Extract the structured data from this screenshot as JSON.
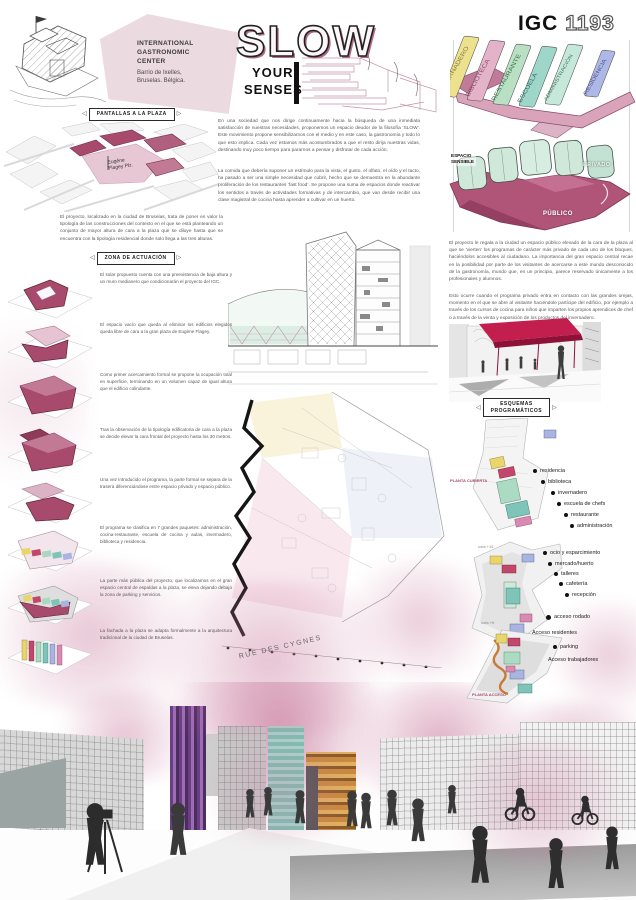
{
  "header": {
    "center_name_1": "INTERNATIONAL",
    "center_name_2": "GASTRONOMIC",
    "center_name_3": "CENTER",
    "center_loc_1": "Barrio de Ixelles,",
    "center_loc_2": "Bruselas. Bélgica.",
    "title_slow": "SLOW",
    "title_your": "YOUR",
    "title_senses": "SENSES",
    "code_prefix": "IGC",
    "code_number": "1193"
  },
  "left": {
    "tag_pantallas": "PANTALLAS A LA PLAZA",
    "map_label_1": "Eugène",
    "map_label_2": "Flagey Plz.",
    "intro": "El proyecto, localizado en la ciudad de Bruselas, trata de poner en valor la tipología de las construcciones del contexto en el que se está planteando un conjunto de mayor altura de cara a la plaza que se diluye hasta que se encuentra con la tipología residencial donde solo llega a las tres alturas.",
    "tag_zona": "ZONA DE ACTUACIÓN",
    "steps": [
      "El solar propuesto cuenta con una preexistencia de baja altura y un muro medianero que condicionarán el proyecto del IGC.",
      "El espacio vacío que queda al eliminar los edificios elegidos queda libre de cara a la gran plaza de Eugène Flagey.",
      "Como primer acercamiento formal se propone la ocupación total en superficie, terminando en un volumen capaz de igual altura que el edificio colindante.",
      "Tras la observación de la tipología edificatoria de cara a la plaza se decide elevar la cara frontal del proyecto hasta los 30 metros.",
      "Una vez introducido el programa, la parte formal se separa de la trasera diferenciándose entre espacio privado y espacio público.",
      "El programa se clasifica en 7 grandes paquetes: administración, cocina-restaurante, escuela de cocina y aulas, invernadero, biblioteca y residencia.",
      "La parte más pública del proyecto, que localizamos en el gran espacio central de espaldas a la plaza, se eleva dejando debajo la zona de parking y servicios.",
      "La fachada a la plaza se adapta formalmente a la arquitectura tradicional de la ciudad de Bruselas."
    ]
  },
  "center": {
    "para1": "En una sociedad que nos dirige continuamente hacia la búsqueda de una inmediata satisfacción de nuestras necesidades, proponemos un espacio deudor de la filosofía ‘SLOW’. Este movimiento propone sensibilizarnos con el medio y en este caso, la gastronomía y todo lo que esto implica. Cada vez estamos más acostumbrados a que el resto dirija nuestras vidas, destinando muy poco tiempo para pararnos a pensar y disfrutar de cada acción.",
    "para2": "La comida que debería suponer un estímulo para la vista, el gusto, el olfato, el oído y el tacto, ha pasado a ser una simple necesidad que cubrir, hecho que se demuestra en la abundante proliferación de los restaurantes ‘fast food’. Se propone una suma de espacios donde reactivar los sentidos a través de actividades formativas y de intercambio, que van desde recibir una clase magistral de cocina hasta aprender a cultivar en un huerto.",
    "street_label": "RUE DES CYGNES"
  },
  "right": {
    "slab_labels": [
      "INVERNADERO",
      "BIBLIOTECA",
      "RESTAURANTE",
      "ESCUELA",
      "ADMINISTRACIÓN",
      "RESIDENCIA"
    ],
    "zone_sensible_1": "ESPACIO",
    "zone_sensible_2": "SENSIBLE",
    "zone_privado": "PRIVADO",
    "zone_publico": "PÚBLICO",
    "para1": "El proyecto le regala a la ciudad un espacio público elevado de la cara de la plaza al que se ‘vierten’ los programas de carácter más privado de cada uno de los bloques, haciéndolos accesibles al ciudadano. La importancia del gran espacio central recae en la posibilidad por parte de los visitantes de acercarse a este mundo desconocido de la gastronomía, mundo que, en un principio, parece reservado únicamente a los profesionales y alumnos.",
    "para2": "Esto ocurre cuando el programa privado entra en contacto con las grandes orejas, momento en el que se abre al visitante haciéndole partícipe del edificio, por ejemplo a través de los cursos de cocina para niños que imparten los propios aprendices de chef o a través de la venta y exposición de los productos del invernadero.",
    "tag_esquemas_1": "ESQUEMAS",
    "tag_esquemas_2": "PROGRAMÁTICOS",
    "plan1": {
      "side_label": "PLANTA CUBIERTA",
      "legend": [
        "residencia",
        "biblioteca",
        "invernadero",
        "escuela de chefs",
        "restaurante",
        "administración"
      ]
    },
    "plan2": {
      "side_label": "cota +15",
      "legend": [
        "ocio y esparcimiento",
        "mercado/huerto",
        "talleres",
        "cafetería",
        "recepción"
      ],
      "extra": "acceso rodado"
    },
    "plan3": {
      "side_label": "cota +6",
      "bottom_label": "PLANTA ACCESO",
      "legend": [
        "Acceso residentes",
        "parking",
        "Acceso trabajadores"
      ]
    }
  },
  "colors": {
    "accent_crimson": "#c21f4e",
    "dark_pink": "#a84a6b",
    "light_pink": "#e3c3d2",
    "mint": "#cfe8da",
    "teal": "#7ec4b8",
    "yellow": "#e8d56b",
    "lavender": "#aab4e0",
    "purple_tower": "#6e4a85",
    "orange": "#c98a3e"
  }
}
